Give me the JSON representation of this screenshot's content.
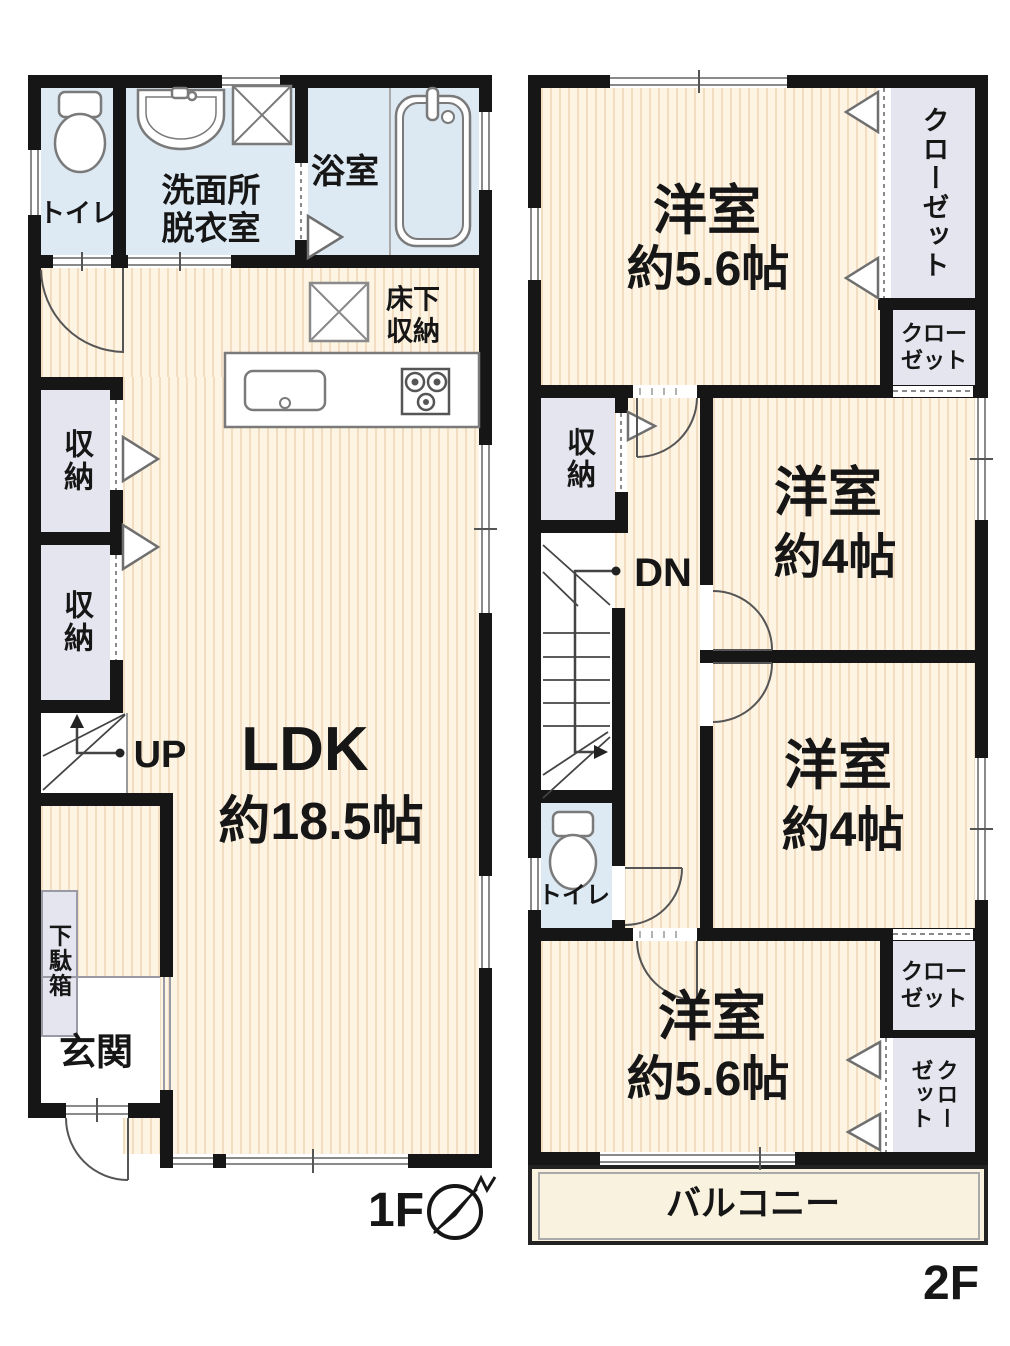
{
  "f1": {
    "floor_label": "1F",
    "toilet": "トイレ",
    "washroom1": "洗面所",
    "washroom2": "脱衣室",
    "bath": "浴室",
    "underfloor1": "床下",
    "underfloor2": "収納",
    "storage1": "収納",
    "storage2": "収納",
    "up": "UP",
    "ldk1": "LDK",
    "ldk2": "約18.5帖",
    "shoebox": "下駄箱",
    "entrance": "玄関"
  },
  "f2": {
    "floor_label": "2F",
    "room_top1": "洋室",
    "room_top2": "約5.6帖",
    "closet_tall": "クローゼット",
    "closet_top_a": "クロー",
    "closet_top_b": "ゼット",
    "storage": "収納",
    "dn": "DN",
    "room_mid1a": "洋室",
    "room_mid1b": "約4帖",
    "room_mid2a": "洋室",
    "room_mid2b": "約4帖",
    "toilet": "トイレ",
    "room_bottom1": "洋室",
    "room_bottom2": "約5.6帖",
    "closet_bot_a": "クロー",
    "closet_bot_b": "ゼット",
    "closet_v_col1": "クロー",
    "closet_v_col2": "ゼット",
    "balcony": "バルコニー"
  },
  "colors": {
    "wall": "#161616",
    "floor_base": "#fdf4e3",
    "floor_stripe": "#f3ddc0",
    "wet_room": "#dde9f3",
    "closet": "#e5e5f0",
    "balcony": "#f8f2de",
    "fixture_line": "#7a7a7a"
  }
}
